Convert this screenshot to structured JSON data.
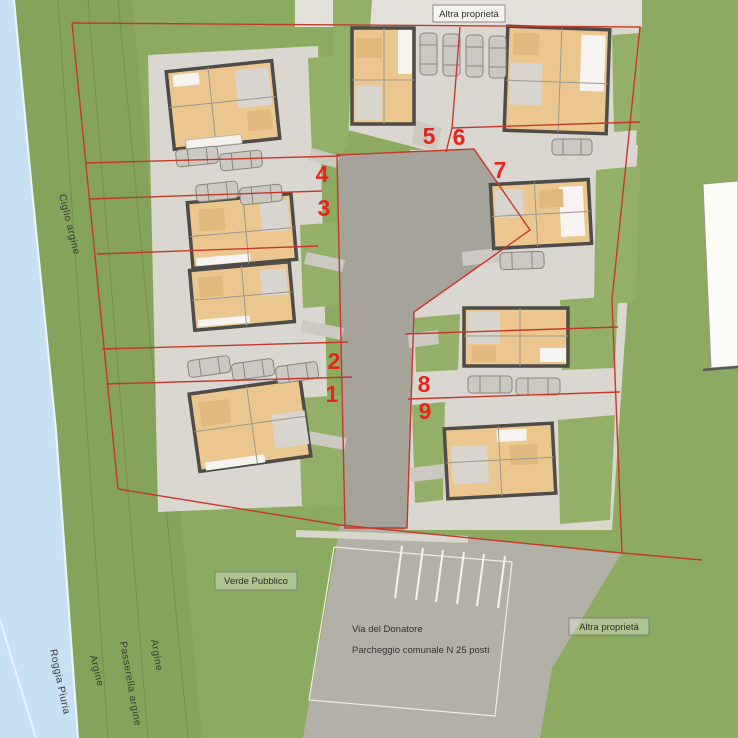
{
  "plan": {
    "labels": {
      "top_property": "Altra proprietà",
      "bottom_property": "Altra proprietà",
      "public_green": "Verde Pubblico",
      "street": "Via del Donatore",
      "parking": "Parcheggio comunale N 25 posti",
      "bank_edge": "Ciglio argine",
      "river": "Roggia Piuria",
      "bank_1": "Argine",
      "walkway": "Passerella argine",
      "bank_2": "Argine"
    },
    "lots": [
      {
        "n": "1"
      },
      {
        "n": "2"
      },
      {
        "n": "3"
      },
      {
        "n": "4"
      },
      {
        "n": "5"
      },
      {
        "n": "6"
      },
      {
        "n": "7"
      },
      {
        "n": "8"
      },
      {
        "n": "9"
      }
    ],
    "colors": {
      "field_green": "#8dab60",
      "bank_green": "#85a35a",
      "water_blue": "#c7e0f2",
      "plaza_gray": "#dad7d0",
      "driveway_gray": "#a6a39b",
      "road_gray": "#b3b0a8",
      "pale_property": "#e2e0d9",
      "boundary_red": "#c5392b",
      "lot_number_red": "#e5261e",
      "floor_tan": "#ebc78f",
      "wall_dark": "#4e4c48"
    }
  }
}
